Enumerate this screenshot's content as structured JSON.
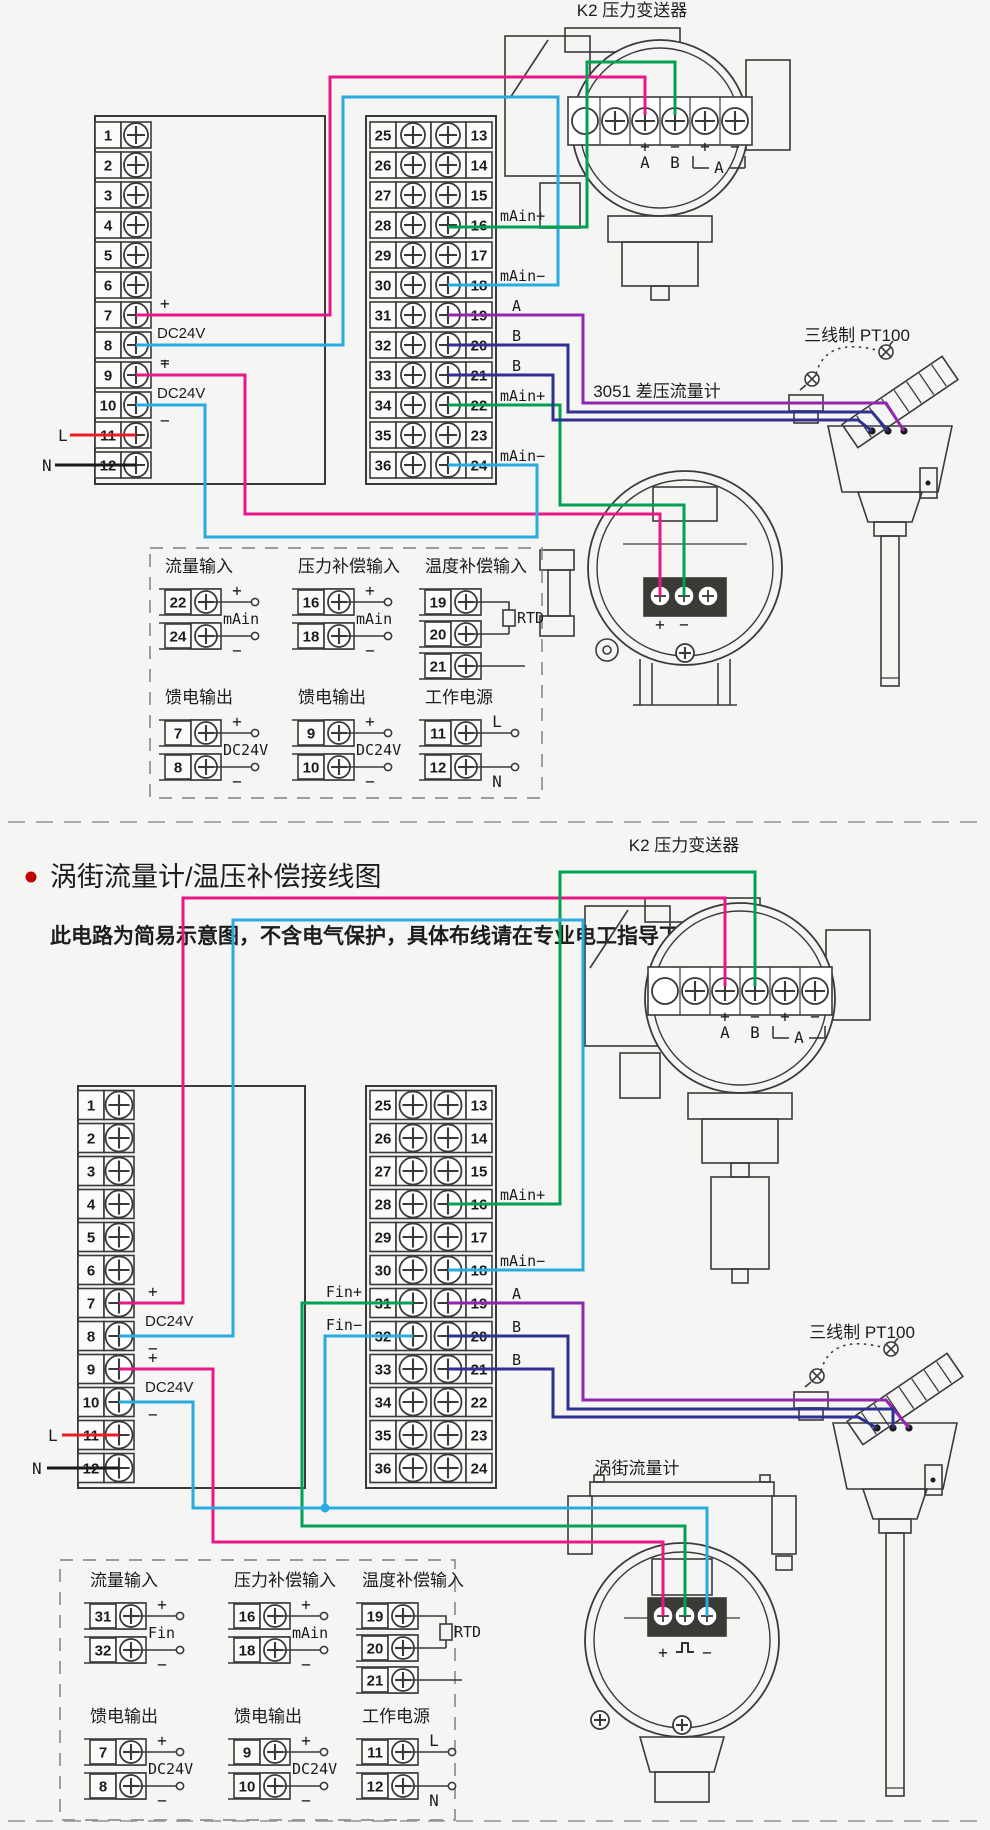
{
  "colors": {
    "background": "#f5f5f3",
    "outline": "#3a3a38",
    "magenta": "#e81889",
    "cyan": "#29abe2",
    "green": "#00a152",
    "purple": "#9126b1",
    "navy": "#2e3192",
    "red": "#ed1c24",
    "black": "#1a1a1a",
    "dashed": "#8f8f8f",
    "bullet": "#c00000"
  },
  "section_title": {
    "title": "涡街流量计/温压补偿接线图",
    "subtitle": "此电路为简易示意图，不含电气保护，具体布线请在专业电工指导下进行；"
  },
  "terminal_numbers": {
    "left": [
      "1",
      "2",
      "3",
      "4",
      "5",
      "6",
      "7",
      "8",
      "9",
      "10",
      "11",
      "12"
    ],
    "mid": [
      "25",
      "26",
      "27",
      "28",
      "29",
      "30",
      "31",
      "32",
      "33",
      "34",
      "35",
      "36"
    ],
    "right": [
      "13",
      "14",
      "15",
      "16",
      "17",
      "18",
      "19",
      "20",
      "21",
      "22",
      "23",
      "24"
    ]
  },
  "power_labels": {
    "plus": "+",
    "minus": "−",
    "dc24v": "DC24V",
    "line": "L",
    "neutral": "N"
  },
  "k2": {
    "title": "K2 压力变送器",
    "terminal_signs": [
      "+",
      "−",
      "+",
      "−"
    ],
    "channel_labels": [
      "A",
      "B"
    ],
    "bracket_label": "A"
  },
  "pt100": {
    "title": "三线制 PT100"
  },
  "diagram1": {
    "flow_meter_title": "3051 差压流量计",
    "flow_terminal_signs": [
      "+",
      "−"
    ],
    "signal_labels": {
      "16": "mAin+",
      "18": "mAin−",
      "19": "A",
      "20": "B",
      "21": "B",
      "22": "mAin+",
      "24": "mAin−"
    },
    "legend": {
      "groups": [
        {
          "title": "流量输入",
          "terminals": [
            "22",
            "24"
          ],
          "signs": [
            "+",
            "−"
          ],
          "mid": "mAin"
        },
        {
          "title": "压力补偿输入",
          "terminals": [
            "16",
            "18"
          ],
          "signs": [
            "+",
            "−"
          ],
          "mid": "mAin"
        },
        {
          "title": "温度补偿输入",
          "terminals": [
            "19",
            "20",
            "21"
          ],
          "rtd": "RTD"
        },
        {
          "title": "馈电输出",
          "terminals": [
            "7",
            "8"
          ],
          "signs": [
            "+",
            "−"
          ],
          "mid": "DC24V"
        },
        {
          "title": "馈电输出",
          "terminals": [
            "9",
            "10"
          ],
          "signs": [
            "+",
            "−"
          ],
          "mid": "DC24V"
        },
        {
          "title": "工作电源",
          "terminals": [
            "11",
            "12"
          ],
          "signs": [
            "L",
            "N"
          ]
        }
      ]
    }
  },
  "diagram2": {
    "flow_meter_title": "涡街流量计",
    "flow_terminal_signs": [
      "+",
      "−"
    ],
    "signal_labels": {
      "16": "mAin+",
      "18": "mAin−",
      "19": "A",
      "20": "B",
      "21": "B"
    },
    "input_labels": {
      "31": "Fin+",
      "32": "Fin−"
    },
    "legend": {
      "groups": [
        {
          "title": "流量输入",
          "terminals": [
            "31",
            "32"
          ],
          "signs": [
            "+",
            "−"
          ],
          "mid": "Fin"
        },
        {
          "title": "压力补偿输入",
          "terminals": [
            "16",
            "18"
          ],
          "signs": [
            "+",
            "−"
          ],
          "mid": "mAin"
        },
        {
          "title": "温度补偿输入",
          "terminals": [
            "19",
            "20",
            "21"
          ],
          "rtd": "RTD"
        },
        {
          "title": "馈电输出",
          "terminals": [
            "7",
            "8"
          ],
          "signs": [
            "+",
            "−"
          ],
          "mid": "DC24V"
        },
        {
          "title": "馈电输出",
          "terminals": [
            "9",
            "10"
          ],
          "signs": [
            "+",
            "−"
          ],
          "mid": "DC24V"
        },
        {
          "title": "工作电源",
          "terminals": [
            "11",
            "12"
          ],
          "signs": [
            "L",
            "N"
          ]
        }
      ]
    }
  }
}
